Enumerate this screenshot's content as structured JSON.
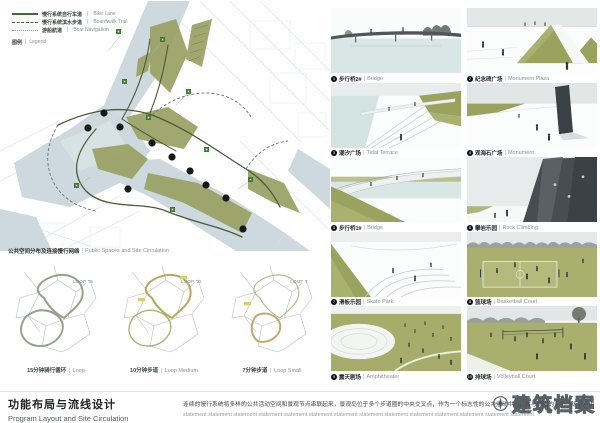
{
  "sep": "|",
  "legend": {
    "title_cn": "图例",
    "title_en": "Legend",
    "items": [
      {
        "style": "solid",
        "label_cn": "慢行系统自行车道",
        "label_en": "Bike Lane"
      },
      {
        "style": "dashed",
        "label_cn": "慢行系统滨水步道",
        "label_en": "Boardwalk Trail"
      },
      {
        "style": "dotted",
        "label_cn": "游船航道",
        "label_en": "Boat Navigation"
      }
    ]
  },
  "map": {
    "caption_cn": "公共空间分布及连接慢行网络",
    "caption_en": "Public Spaces and Site Circulation"
  },
  "loops": [
    {
      "badge": "LOOP 15",
      "label_cn": "15分钟骑行循环",
      "label_en": "Loop"
    },
    {
      "badge": "LOOP 10",
      "label_cn": "10分钟步道",
      "label_en": "Loop Medium"
    },
    {
      "badge": "LOOP 7",
      "label_cn": "7分钟步道",
      "label_en": "Loop Small"
    }
  ],
  "title": {
    "cn": "功能布局与流线设计",
    "en": "Program Layout and Site Circulation"
  },
  "description": {
    "line1": "连续的慢行系统将多样的公共活动空间和景观节点串联起来，景观岛位于多个步道圈的中央交叉点，作为一个标志性的公共活动中心，并与周围的多个二级节点由一级步道串联起来。",
    "line2": "statement statement statement statement statement statement statement statement statement statement statement statement statement statement"
  },
  "watermark": {
    "text": "建筑档案"
  },
  "gallery": {
    "items": [
      {
        "num": "1",
        "label_cn": "步行桥2#",
        "label_en": "Bridge"
      },
      {
        "num": "2",
        "label_cn": "纪念碑广场",
        "label_en": "Monument Plaza"
      },
      {
        "num": "3",
        "label_cn": "潮汐广场",
        "label_en": "Tidal Terrace"
      },
      {
        "num": "4",
        "label_cn": "观海石广场",
        "label_en": "Monument"
      },
      {
        "num": "5",
        "label_cn": "步行桥1#",
        "label_en": "Bridge"
      },
      {
        "num": "6",
        "label_cn": "攀岩乐园",
        "label_en": "Rock Climbing"
      },
      {
        "num": "7",
        "label_cn": "滑板乐园",
        "label_en": "Skate Park"
      },
      {
        "num": "8",
        "label_cn": "篮球场",
        "label_en": "Basketball Court"
      },
      {
        "num": "9",
        "label_cn": "露天剧场",
        "label_en": "Amphitheater"
      },
      {
        "num": "10",
        "label_cn": "排球场",
        "label_en": "Volleyball Court"
      }
    ]
  },
  "colors": {
    "water": "#cdd9de",
    "park_green": "#99a163",
    "route_green": "#4d5a39",
    "badge_green": "#3c7a33",
    "loop_yellow": "#b3ab5c",
    "loop_tan": "#c0a974"
  }
}
